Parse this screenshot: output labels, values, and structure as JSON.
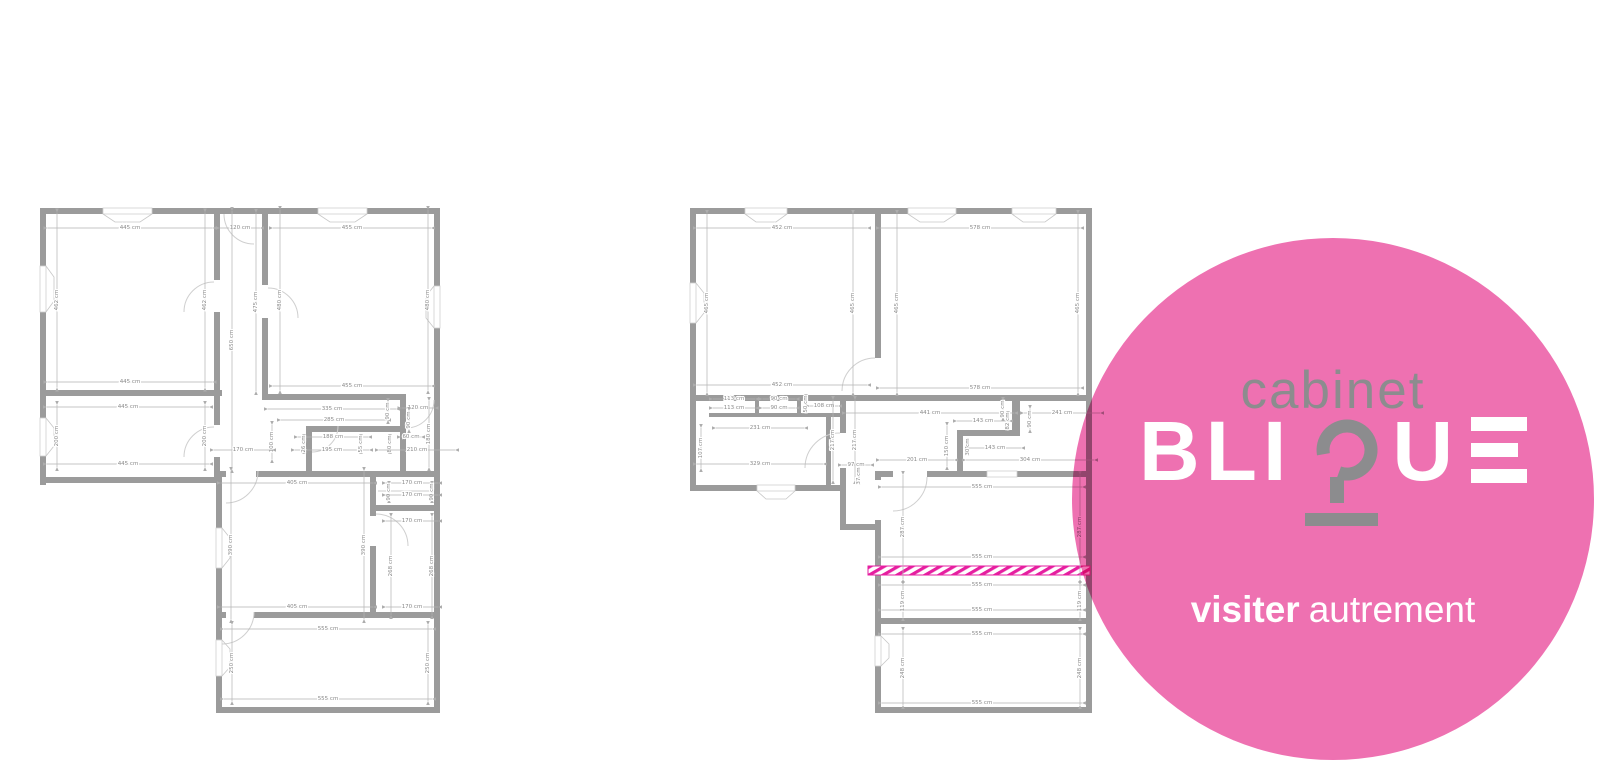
{
  "page": {
    "width": 1600,
    "height": 765,
    "background": "#ffffff"
  },
  "logo": {
    "line1": "cabinet",
    "brand": "BLIQUE",
    "brand_bli": "BLI",
    "brand_u": "U",
    "tagline_bold": "visiter",
    "tagline_light": "autrement",
    "circle_color": "#ee71b1",
    "text_gray": "#8c8c8e",
    "text_white": "#ffffff"
  },
  "highlight_strip": {
    "color": "#e61ea0"
  },
  "floorplans": {
    "left": {
      "dimensions": [
        {
          "t": "445 cm",
          "x": 130,
          "y": 228,
          "o": "h",
          "l": 165
        },
        {
          "t": "120 cm",
          "x": 240,
          "y": 228,
          "o": "h",
          "l": 40
        },
        {
          "t": "455 cm",
          "x": 352,
          "y": 228,
          "o": "h",
          "l": 158
        },
        {
          "t": "462 cm",
          "x": 57,
          "y": 300,
          "o": "v",
          "l": 175
        },
        {
          "t": "462 cm",
          "x": 205,
          "y": 300,
          "o": "v",
          "l": 175
        },
        {
          "t": "650 cm",
          "x": 232,
          "y": 340,
          "o": "v",
          "l": 258
        },
        {
          "t": "475 cm",
          "x": 256,
          "y": 302,
          "o": "v",
          "l": 178
        },
        {
          "t": "480 cm",
          "x": 280,
          "y": 300,
          "o": "v",
          "l": 180
        },
        {
          "t": "480 cm",
          "x": 428,
          "y": 300,
          "o": "v",
          "l": 180
        },
        {
          "t": "445 cm",
          "x": 130,
          "y": 382,
          "o": "h",
          "l": 165
        },
        {
          "t": "455 cm",
          "x": 352,
          "y": 386,
          "o": "h",
          "l": 158
        },
        {
          "t": "445 cm",
          "x": 128,
          "y": 407,
          "o": "h",
          "l": 162
        },
        {
          "t": "200 cm",
          "x": 57,
          "y": 436,
          "o": "v",
          "l": 62
        },
        {
          "t": "200 cm",
          "x": 205,
          "y": 436,
          "o": "v",
          "l": 62
        },
        {
          "t": "445 cm",
          "x": 128,
          "y": 464,
          "o": "h",
          "l": 162
        },
        {
          "t": "335 cm",
          "x": 332,
          "y": 409,
          "o": "h",
          "l": 128
        },
        {
          "t": "285 cm",
          "x": 334,
          "y": 420,
          "o": "h",
          "l": 106
        },
        {
          "t": "120 cm",
          "x": 418,
          "y": 408,
          "o": "h",
          "l": 33
        },
        {
          "t": "90 cm",
          "x": 388,
          "y": 411,
          "o": "v",
          "l": 18
        },
        {
          "t": "90 cm",
          "x": 409,
          "y": 420,
          "o": "v",
          "l": 18
        },
        {
          "t": "180 cm",
          "x": 429,
          "y": 434,
          "o": "v",
          "l": 66
        },
        {
          "t": "100 cm",
          "x": 272,
          "y": 442,
          "o": "v",
          "l": 34
        },
        {
          "t": "170 cm",
          "x": 243,
          "y": 450,
          "o": "h",
          "l": 58
        },
        {
          "t": "188 cm",
          "x": 333,
          "y": 437,
          "o": "h",
          "l": 70
        },
        {
          "t": "195 cm",
          "x": 332,
          "y": 450,
          "o": "h",
          "l": 74
        },
        {
          "t": "26 cm",
          "x": 304,
          "y": 444,
          "o": "v",
          "l": 12
        },
        {
          "t": "55 cm",
          "x": 361,
          "y": 444,
          "o": "v",
          "l": 12
        },
        {
          "t": "80 cm",
          "x": 390,
          "y": 444,
          "o": "v",
          "l": 12
        },
        {
          "t": "60 cm",
          "x": 411,
          "y": 437,
          "o": "h",
          "l": 20
        },
        {
          "t": "210 cm",
          "x": 417,
          "y": 450,
          "o": "h",
          "l": 76
        },
        {
          "t": "405 cm",
          "x": 297,
          "y": 483,
          "o": "h",
          "l": 152
        },
        {
          "t": "170 cm",
          "x": 412,
          "y": 483,
          "o": "h",
          "l": 52
        },
        {
          "t": "90 cm",
          "x": 389,
          "y": 492,
          "o": "v",
          "l": 14
        },
        {
          "t": "90 cm",
          "x": 432,
          "y": 492,
          "o": "v",
          "l": 14
        },
        {
          "t": "170 cm",
          "x": 412,
          "y": 495,
          "o": "h",
          "l": 52
        },
        {
          "t": "170 cm",
          "x": 412,
          "y": 521,
          "o": "h",
          "l": 52
        },
        {
          "t": "390 cm",
          "x": 231,
          "y": 545,
          "o": "v",
          "l": 148
        },
        {
          "t": "390 cm",
          "x": 364,
          "y": 545,
          "o": "v",
          "l": 148
        },
        {
          "t": "268 cm",
          "x": 391,
          "y": 566,
          "o": "v",
          "l": 98
        },
        {
          "t": "268 cm",
          "x": 432,
          "y": 566,
          "o": "v",
          "l": 98
        },
        {
          "t": "405 cm",
          "x": 297,
          "y": 607,
          "o": "h",
          "l": 152
        },
        {
          "t": "170 cm",
          "x": 412,
          "y": 607,
          "o": "h",
          "l": 52
        },
        {
          "t": "555 cm",
          "x": 328,
          "y": 629,
          "o": "h",
          "l": 208
        },
        {
          "t": "250 cm",
          "x": 232,
          "y": 663,
          "o": "v",
          "l": 76
        },
        {
          "t": "250 cm",
          "x": 428,
          "y": 663,
          "o": "v",
          "l": 76
        },
        {
          "t": "555 cm",
          "x": 328,
          "y": 699,
          "o": "h",
          "l": 208
        }
      ]
    },
    "right": {
      "dimensions": [
        {
          "t": "452 cm",
          "x": 782,
          "y": 228,
          "o": "h",
          "l": 170
        },
        {
          "t": "578 cm",
          "x": 980,
          "y": 228,
          "o": "h",
          "l": 200
        },
        {
          "t": "465 cm",
          "x": 707,
          "y": 303,
          "o": "v",
          "l": 178
        },
        {
          "t": "465 cm",
          "x": 853,
          "y": 303,
          "o": "v",
          "l": 178
        },
        {
          "t": "465 cm",
          "x": 897,
          "y": 303,
          "o": "v",
          "l": 178
        },
        {
          "t": "465 cm",
          "x": 1078,
          "y": 303,
          "o": "v",
          "l": 178
        },
        {
          "t": "452 cm",
          "x": 782,
          "y": 385,
          "o": "h",
          "l": 170
        },
        {
          "t": "578 cm",
          "x": 980,
          "y": 388,
          "o": "h",
          "l": 200
        },
        {
          "t": "113 cm",
          "x": 734,
          "y": 399,
          "o": "h",
          "l": 42
        },
        {
          "t": "113 cm",
          "x": 734,
          "y": 408,
          "o": "h",
          "l": 42
        },
        {
          "t": "90 cm",
          "x": 779,
          "y": 399,
          "o": "h",
          "l": 33
        },
        {
          "t": "90 cm",
          "x": 779,
          "y": 408,
          "o": "h",
          "l": 33
        },
        {
          "t": "108 cm",
          "x": 824,
          "y": 406,
          "o": "h",
          "l": 28
        },
        {
          "t": "50 cm",
          "x": 806,
          "y": 404,
          "o": "v",
          "l": 12
        },
        {
          "t": "231 cm",
          "x": 760,
          "y": 428,
          "o": "h",
          "l": 88
        },
        {
          "t": "107 cm",
          "x": 701,
          "y": 448,
          "o": "v",
          "l": 40
        },
        {
          "t": "217 cm",
          "x": 833,
          "y": 440,
          "o": "v",
          "l": 80
        },
        {
          "t": "217 cm",
          "x": 855,
          "y": 440,
          "o": "v",
          "l": 80
        },
        {
          "t": "329 cm",
          "x": 760,
          "y": 464,
          "o": "h",
          "l": 126
        },
        {
          "t": "97 cm",
          "x": 856,
          "y": 465,
          "o": "h",
          "l": 28
        },
        {
          "t": "37 cm",
          "x": 859,
          "y": 476,
          "o": "v",
          "l": 10
        },
        {
          "t": "441 cm",
          "x": 930,
          "y": 413,
          "o": "h",
          "l": 168
        },
        {
          "t": "241 cm",
          "x": 1062,
          "y": 413,
          "o": "h",
          "l": 76
        },
        {
          "t": "90 cm",
          "x": 1003,
          "y": 409,
          "o": "v",
          "l": 16
        },
        {
          "t": "90 cm",
          "x": 1030,
          "y": 419,
          "o": "v",
          "l": 20
        },
        {
          "t": "143 cm",
          "x": 983,
          "y": 421,
          "o": "h",
          "l": 52
        },
        {
          "t": "82 cm",
          "x": 1008,
          "y": 421,
          "o": "v",
          "l": 12
        },
        {
          "t": "150 cm",
          "x": 947,
          "y": 446,
          "o": "v",
          "l": 40
        },
        {
          "t": "143 cm",
          "x": 995,
          "y": 448,
          "o": "h",
          "l": 52
        },
        {
          "t": "30 cm",
          "x": 968,
          "y": 447,
          "o": "v",
          "l": 10
        },
        {
          "t": "201 cm",
          "x": 917,
          "y": 460,
          "o": "h",
          "l": 74
        },
        {
          "t": "304 cm",
          "x": 1030,
          "y": 460,
          "o": "h",
          "l": 128
        },
        {
          "t": "555 cm",
          "x": 982,
          "y": 487,
          "o": "h",
          "l": 200
        },
        {
          "t": "287 cm",
          "x": 903,
          "y": 527,
          "o": "v",
          "l": 104
        },
        {
          "t": "287 cm",
          "x": 1080,
          "y": 527,
          "o": "v",
          "l": 104
        },
        {
          "t": "555 cm",
          "x": 982,
          "y": 557,
          "o": "h",
          "l": 200
        },
        {
          "t": "555 cm",
          "x": 982,
          "y": 585,
          "o": "h",
          "l": 200
        },
        {
          "t": "119 cm",
          "x": 903,
          "y": 601,
          "o": "v",
          "l": 32
        },
        {
          "t": "119 cm",
          "x": 1080,
          "y": 601,
          "o": "v",
          "l": 32
        },
        {
          "t": "555 cm",
          "x": 982,
          "y": 610,
          "o": "h",
          "l": 200
        },
        {
          "t": "555 cm",
          "x": 982,
          "y": 634,
          "o": "h",
          "l": 200
        },
        {
          "t": "248 cm",
          "x": 903,
          "y": 668,
          "o": "v",
          "l": 74
        },
        {
          "t": "248 cm",
          "x": 1080,
          "y": 668,
          "o": "v",
          "l": 74
        },
        {
          "t": "555 cm",
          "x": 982,
          "y": 703,
          "o": "h",
          "l": 200
        }
      ]
    }
  }
}
